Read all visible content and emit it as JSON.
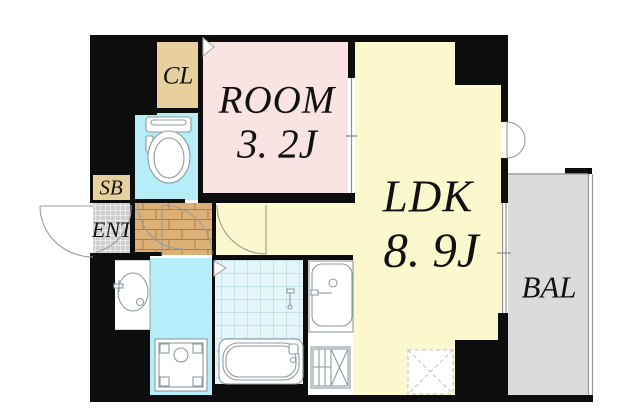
{
  "floorplan": {
    "rooms": {
      "closet": {
        "label": "CL"
      },
      "shoe_box": {
        "label": "SB"
      },
      "entrance": {
        "label": "ENT"
      },
      "bedroom": {
        "label": "ROOM",
        "size": "3. 2J"
      },
      "living": {
        "label": "LDK",
        "size": "8. 9J"
      },
      "balcony": {
        "label": "BAL"
      }
    },
    "fixtures": [
      "toilet-icon",
      "washbasin-icon",
      "washing-machine-pan-icon",
      "bathtub-icon",
      "shower-tap-icon",
      "kitchen-sink-icon",
      "stove-icon",
      "floor-hatch-icon"
    ],
    "colors": {
      "wall": "#0d0d0d",
      "bedroom_pink": "#f9e3e3",
      "living_yellow": "#fcf8cd",
      "water_cyan": "#b5edf8",
      "bath_tile": "#e4f6f9",
      "bath_tile_line": "#a9d0da",
      "closet_tan": "#e7d09e",
      "wood_floor": "#dcb077",
      "wood_line": "#a97f4f",
      "entrance_tile": "#cfcfcf",
      "balcony_gray": "#dbdbdb",
      "fixture_line": "#8e9aa2"
    }
  }
}
